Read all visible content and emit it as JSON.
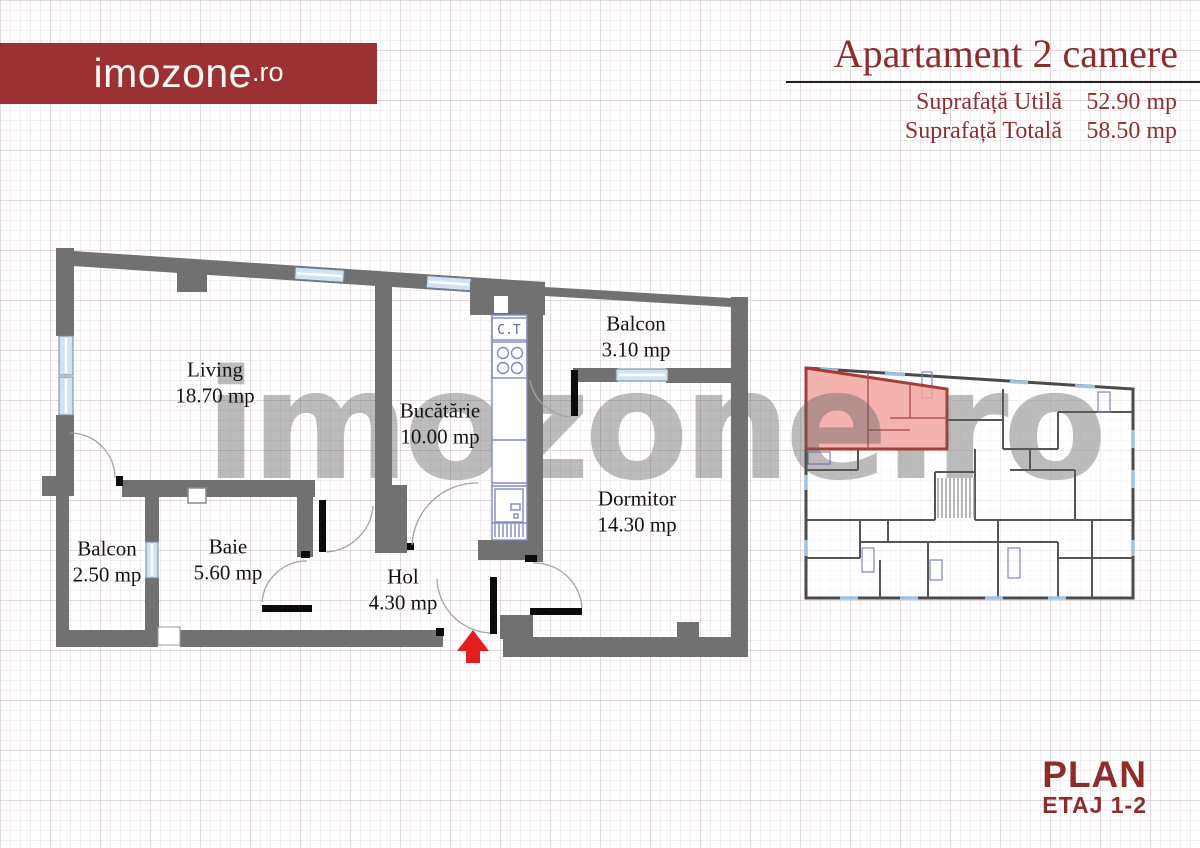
{
  "header": {
    "logo": {
      "name": "imozone",
      "tld": ".ro"
    },
    "title": "Apartament 2 camere",
    "specs": [
      {
        "label": "Suprafață Utilă",
        "value": "52.90 mp"
      },
      {
        "label": "Suprafață Totală",
        "value": "58.50 mp"
      }
    ]
  },
  "floorplan": {
    "rooms": [
      {
        "name": "Living",
        "area": "18.70 mp"
      },
      {
        "name": "Bucătărie",
        "area": "10.00 mp"
      },
      {
        "name": "Balcon",
        "area": "3.10 mp"
      },
      {
        "name": "Dormitor",
        "area": "14.30 mp"
      },
      {
        "name": "Baie",
        "area": "5.60 mp"
      },
      {
        "name": "Balcon",
        "area": "2.50 mp"
      },
      {
        "name": "Hol",
        "area": "4.30 mp"
      }
    ],
    "boiler_label": "C.T"
  },
  "watermark": "imozone.ro",
  "footer": {
    "plan": "PLAN",
    "etaj": "ETAJ 1-2"
  },
  "colors": {
    "brand_red": "#9b3133",
    "title_red": "#8b2c2d",
    "wall_gray": "#717171",
    "watermark_gray": "#b9b9b9",
    "window_blue": "#cfe4f2",
    "fixture_blue": "#8088c2",
    "entrance_arrow_red": "#e41e1e",
    "unit_highlight_fill": "#f1a09b",
    "unit_highlight_stroke": "#a53c39"
  }
}
